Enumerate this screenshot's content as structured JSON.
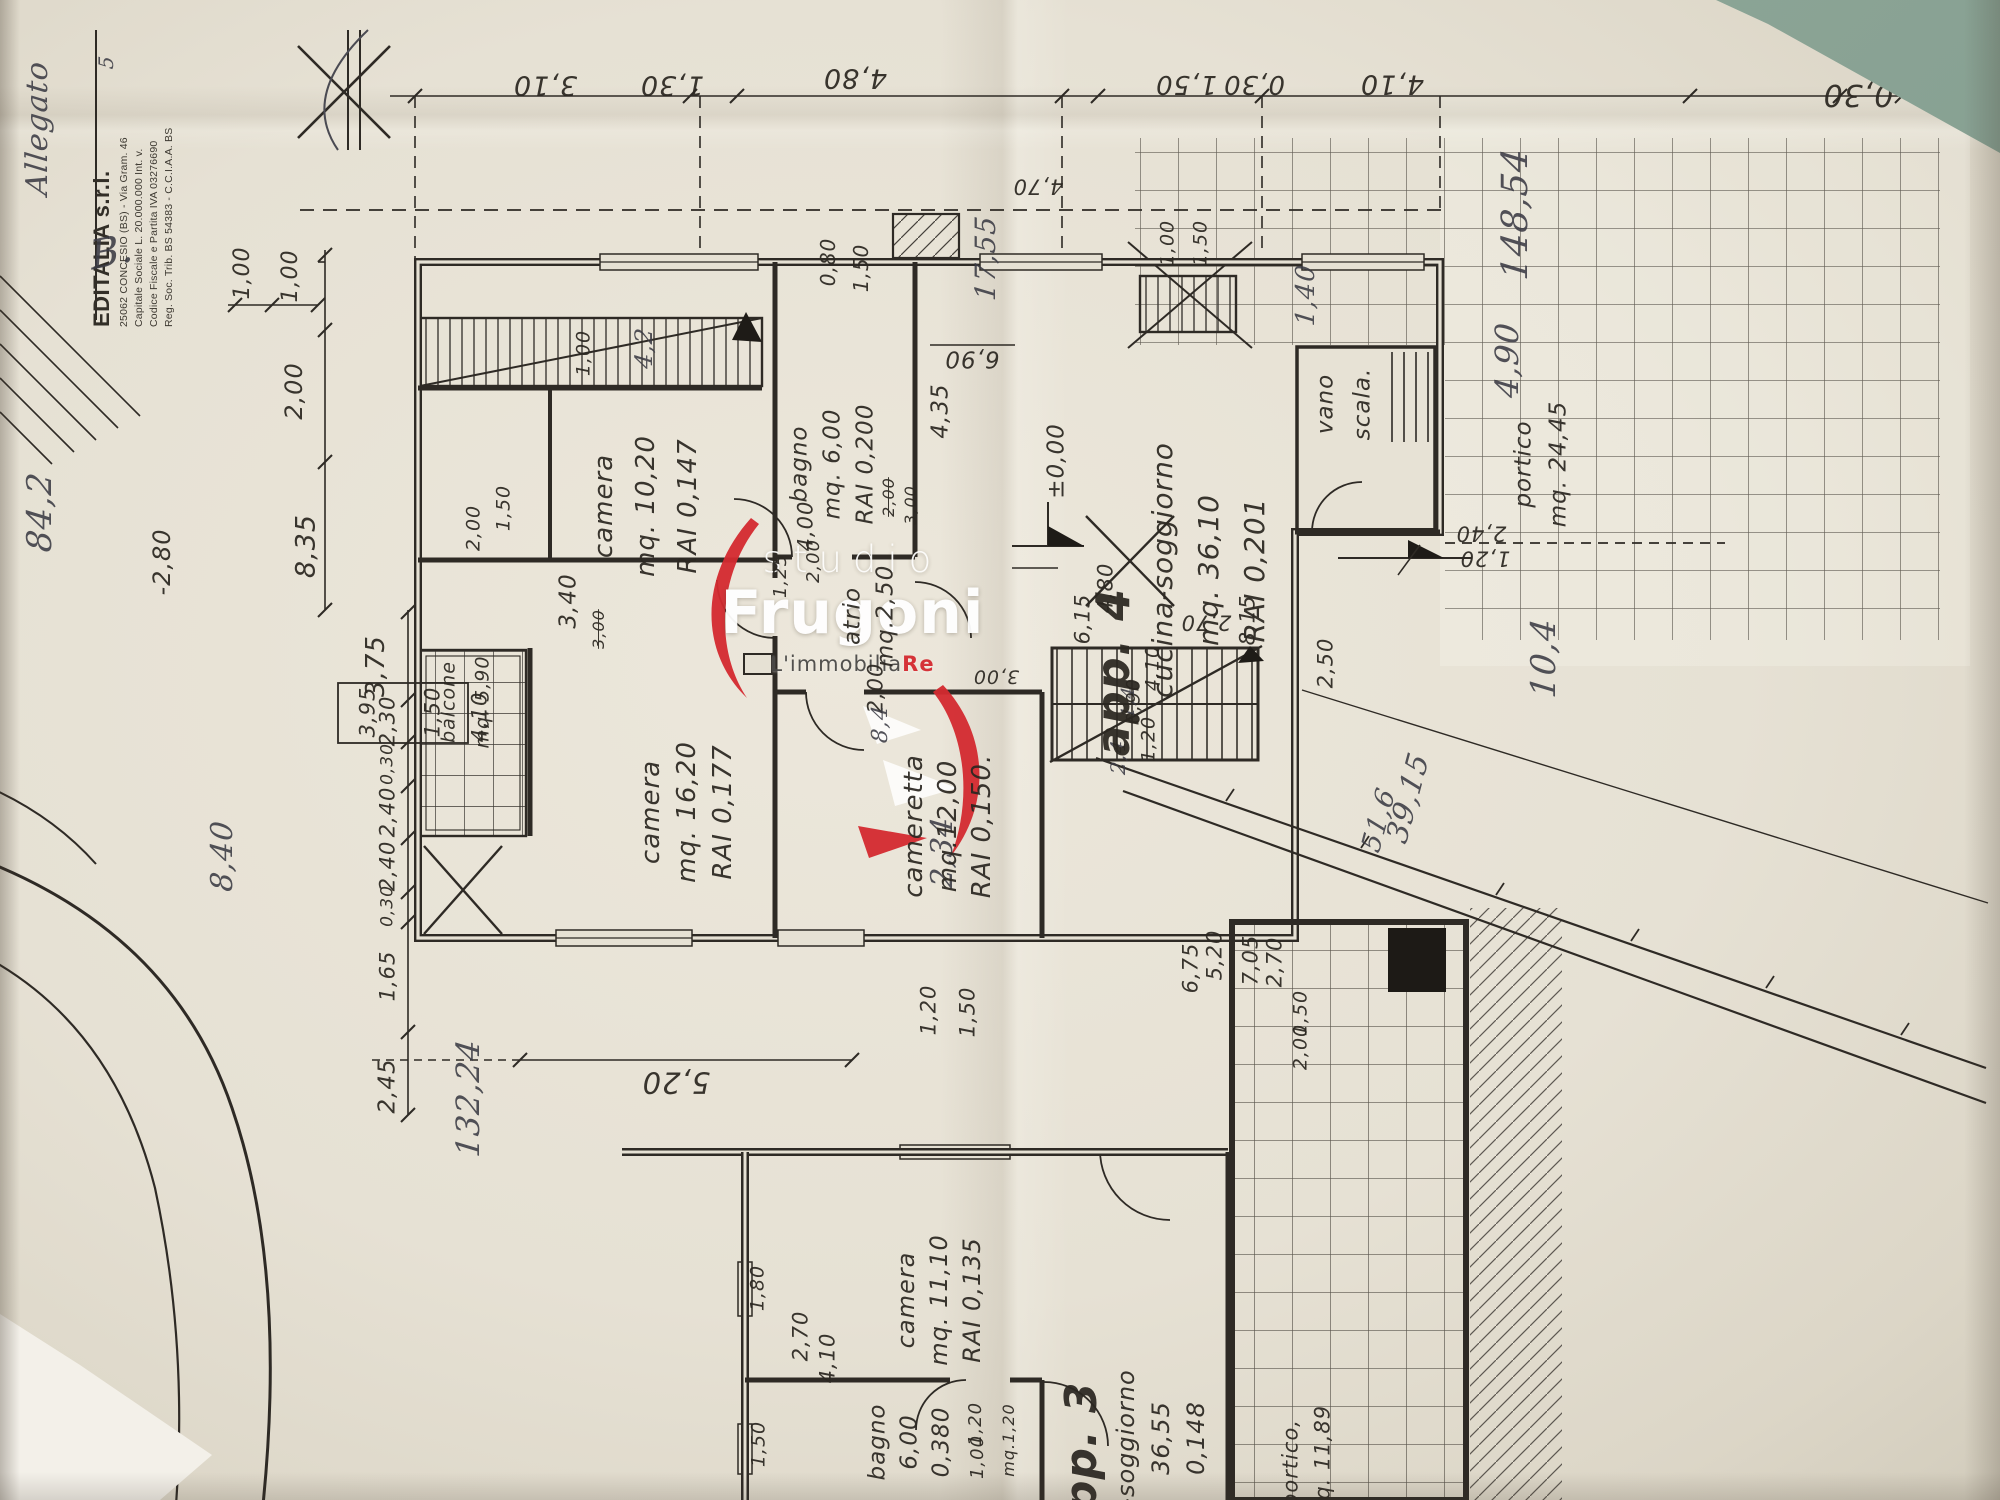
{
  "scene": {
    "type": "scanned floor plan photograph, drawing rotated 90 degrees",
    "paper_color": "#e6e1d4",
    "line_color": "#2e2a25",
    "background_color": "#8aa394",
    "accent_red": "#d42a30"
  },
  "stamp": {
    "company": "EDITALIA s.r.l.",
    "lines": [
      "25062 CONCESIO (BS) - Via Gram. 46",
      "Capitale Sociale L. 20.000.000 Int. v.",
      "Codice Fiscale e Partita IVA 03276690",
      "Reg. Soc. Trib. BS 54383 - C.C.I.A.A. BS"
    ]
  },
  "logo": {
    "studio": "studio",
    "name": "Frugoni",
    "tagline": "L'immobilia",
    "tagline_accent": "Re",
    "accent_color": "#d42a30"
  },
  "rooms": [
    {
      "id": "camera-10",
      "lines": [
        "camera",
        "mq. 10,20",
        "RAI 0,147"
      ],
      "x": 604,
      "y": 506,
      "dx": 42,
      "s": 26
    },
    {
      "id": "bagno",
      "lines": [
        "bagno",
        "mq. 6,00",
        "RAI 0,200"
      ],
      "x": 800,
      "y": 464,
      "dx": 33,
      "s": 23
    },
    {
      "id": "atrio",
      "lines": [
        "atrio",
        "mq.2,50"
      ],
      "x": 853,
      "y": 616,
      "dx": 33,
      "s": 23
    },
    {
      "id": "camera-16",
      "lines": [
        "camera",
        "mq. 16,20",
        "RAI 0,177"
      ],
      "x": 651,
      "y": 812,
      "dx": 36,
      "s": 26
    },
    {
      "id": "cameretta",
      "lines": [
        "cameretta",
        "mq.12,00",
        "RAI 0,150."
      ],
      "x": 914,
      "y": 826,
      "dx": 34,
      "s": 26
    },
    {
      "id": "balcone",
      "lines": [
        "balcone",
        "mq. 5,90"
      ],
      "x": 449,
      "y": 702,
      "dx": 34,
      "s": 19
    },
    {
      "id": "app4",
      "lines": [
        "app. 4"
      ],
      "x": 1113,
      "y": 672,
      "dx": 0,
      "s": 46,
      "w": "bold"
    },
    {
      "id": "cucina-soggiorno",
      "lines": [
        "cucina-soggiorno",
        "mq. 36,10",
        "RAI 0,201"
      ],
      "x": 1163,
      "y": 570,
      "dx": 46,
      "s": 28
    },
    {
      "id": "vano-scala",
      "lines": [
        "vano",
        "scala."
      ],
      "x": 1326,
      "y": 404,
      "dx": 37,
      "s": 23
    },
    {
      "id": "portico-upper",
      "lines": [
        "portico",
        "mq. 24,45"
      ],
      "x": 1524,
      "y": 464,
      "dx": 35,
      "s": 23
    },
    {
      "id": "camera-11",
      "lines": [
        "camera",
        "mq. 11,10",
        "RAI 0,135"
      ],
      "x": 906,
      "y": 1300,
      "dx": 33,
      "s": 24
    },
    {
      "id": "bagno-app3",
      "lines": [
        "bagno",
        "6,00",
        "0,380"
      ],
      "x": 878,
      "y": 1442,
      "dx": 32,
      "s": 23
    },
    {
      "id": "app3",
      "lines": [
        "app. 3"
      ],
      "x": 1082,
      "y": 1462,
      "dx": 0,
      "s": 44,
      "w": "bold"
    },
    {
      "id": "soggiorno-app3",
      "lines": [
        "-soggiorno",
        "36,55",
        "0,148"
      ],
      "x": 1126,
      "y": 1438,
      "dx": 35,
      "s": 24
    },
    {
      "id": "portico-lower",
      "lines": [
        "portico,",
        "mq. 11,89"
      ],
      "x": 1291,
      "y": 1463,
      "dx": 32,
      "s": 21
    }
  ],
  "dim_labels": [
    {
      "t": "3,10",
      "x": 545,
      "y": 85,
      "r": 180,
      "s": 27
    },
    {
      "t": "1,30",
      "x": 672,
      "y": 85,
      "r": 180,
      "s": 27
    },
    {
      "t": "4,80",
      "x": 855,
      "y": 78,
      "r": 180,
      "s": 27
    },
    {
      "t": "1,50",
      "x": 1186,
      "y": 84,
      "r": 180,
      "s": 26
    },
    {
      "t": "0,30",
      "x": 1254,
      "y": 84,
      "r": 180,
      "s": 26
    },
    {
      "t": "4,10",
      "x": 1392,
      "y": 84,
      "r": 180,
      "s": 27
    },
    {
      "t": "0,30",
      "x": 1858,
      "y": 94,
      "r": 180,
      "s": 30
    },
    {
      "t": "4,70",
      "x": 1038,
      "y": 186,
      "r": 180,
      "s": 21
    },
    {
      "t": "1,00",
      "x": 243,
      "y": 273,
      "r": -90,
      "s": 22
    },
    {
      "t": "1,00",
      "x": 291,
      "y": 276,
      "r": -90,
      "s": 22
    },
    {
      "t": "2,00",
      "x": 294,
      "y": 391,
      "r": -90,
      "s": 24
    },
    {
      "t": "8,35",
      "x": 306,
      "y": 546,
      "r": -90,
      "s": 27
    },
    {
      "t": "-2,80",
      "x": 162,
      "y": 562,
      "r": -90,
      "s": 24
    },
    {
      "t": "3,75",
      "x": 376,
      "y": 666,
      "r": -90,
      "s": 26
    },
    {
      "t": "2,30",
      "x": 388,
      "y": 721,
      "r": -90,
      "s": 21
    },
    {
      "t": "0,30",
      "x": 388,
      "y": 764,
      "r": -90,
      "s": 17
    },
    {
      "t": "2,40",
      "x": 388,
      "y": 812,
      "r": -90,
      "s": 21
    },
    {
      "t": "2,40",
      "x": 388,
      "y": 866,
      "r": -90,
      "s": 21
    },
    {
      "t": "0,30",
      "x": 388,
      "y": 906,
      "r": -90,
      "s": 17
    },
    {
      "t": "1,65",
      "x": 388,
      "y": 976,
      "r": -90,
      "s": 21
    },
    {
      "t": "2,45",
      "x": 388,
      "y": 1086,
      "r": -90,
      "s": 23
    },
    {
      "t": "3,95",
      "x": 368,
      "y": 712,
      "r": -90,
      "s": 21
    },
    {
      "t": "1,50",
      "x": 433,
      "y": 712,
      "r": -90,
      "s": 21
    },
    {
      "t": "4,10",
      "x": 480,
      "y": 717,
      "r": -90,
      "s": 21
    },
    {
      "t": "1,00",
      "x": 584,
      "y": 353,
      "r": -90,
      "s": 19
    },
    {
      "t": "2,00",
      "x": 474,
      "y": 528,
      "r": -90,
      "s": 19
    },
    {
      "t": "1,50",
      "x": 504,
      "y": 508,
      "r": -90,
      "s": 19
    },
    {
      "t": "3,40",
      "x": 569,
      "y": 601,
      "r": -90,
      "s": 23
    },
    {
      "t": "3,00",
      "x": 599,
      "y": 629,
      "r": -90,
      "s": 16,
      "strike": true
    },
    {
      "t": "0,80",
      "x": 828,
      "y": 262,
      "r": -90,
      "s": 20
    },
    {
      "t": "1,50",
      "x": 861,
      "y": 268,
      "r": -90,
      "s": 20
    },
    {
      "t": "2,00",
      "x": 889,
      "y": 497,
      "r": -90,
      "s": 16,
      "strike": true
    },
    {
      "t": "3,00",
      "x": 911,
      "y": 505,
      "r": -90,
      "s": 16
    },
    {
      "t": "1,25",
      "x": 781,
      "y": 576,
      "r": -90,
      "s": 18
    },
    {
      "t": "2,00",
      "x": 814,
      "y": 561,
      "r": -90,
      "s": 18
    },
    {
      "t": "6,90",
      "x": 972,
      "y": 358,
      "r": 180,
      "s": 23
    },
    {
      "t": "4,35",
      "x": 941,
      "y": 411,
      "r": -90,
      "s": 23
    },
    {
      "t": "±0,00",
      "x": 1057,
      "y": 461,
      "r": -90,
      "s": 23
    },
    {
      "t": "4,00",
      "x": 806,
      "y": 526,
      "r": -90,
      "s": 21
    },
    {
      "t": "3,00",
      "x": 996,
      "y": 676,
      "r": 180,
      "s": 19
    },
    {
      "t": "1,00",
      "x": 1168,
      "y": 243,
      "r": -90,
      "s": 19
    },
    {
      "t": "1,50",
      "x": 1201,
      "y": 243,
      "r": -90,
      "s": 19
    },
    {
      "t": "2,40",
      "x": 1481,
      "y": 533,
      "r": 180,
      "s": 21
    },
    {
      "t": "1,20",
      "x": 1485,
      "y": 558,
      "r": 180,
      "s": 21
    },
    {
      "t": "2,50",
      "x": 1326,
      "y": 663,
      "r": -90,
      "s": 21
    },
    {
      "t": "2,70",
      "x": 1206,
      "y": 622,
      "r": 180,
      "s": 21
    },
    {
      "t": "8,15",
      "x": 1248,
      "y": 620,
      "r": -90,
      "s": 21
    },
    {
      "t": "6,15",
      "x": 1083,
      "y": 619,
      "r": -90,
      "s": 21
    },
    {
      "t": "4,80",
      "x": 1106,
      "y": 588,
      "r": -90,
      "s": 21
    },
    {
      "t": "2,00",
      "x": 876,
      "y": 688,
      "r": -90,
      "s": 21
    },
    {
      "t": "4,10",
      "x": 1153,
      "y": 668,
      "r": -90,
      "s": 19
    },
    {
      "t": "0,90",
      "x": 1134,
      "y": 701,
      "r": -90,
      "s": 19
    },
    {
      "t": "1,20",
      "x": 1149,
      "y": 739,
      "r": -90,
      "s": 19
    },
    {
      "t": "1,20",
      "x": 929,
      "y": 1010,
      "r": -90,
      "s": 21
    },
    {
      "t": "1,50",
      "x": 968,
      "y": 1012,
      "r": -90,
      "s": 21
    },
    {
      "t": "5,20",
      "x": 676,
      "y": 1082,
      "r": 180,
      "s": 29
    },
    {
      "t": "1,80",
      "x": 758,
      "y": 1288,
      "r": -90,
      "s": 19
    },
    {
      "t": "1,50",
      "x": 759,
      "y": 1444,
      "r": -90,
      "s": 19
    },
    {
      "t": "2,70",
      "x": 801,
      "y": 1336,
      "r": -90,
      "s": 21
    },
    {
      "t": "4,10",
      "x": 828,
      "y": 1358,
      "r": -90,
      "s": 21
    },
    {
      "t": "1,20",
      "x": 976,
      "y": 1424,
      "r": -90,
      "s": 18
    },
    {
      "t": "1,00",
      "x": 978,
      "y": 1457,
      "r": -90,
      "s": 18
    },
    {
      "t": "mq.1,20",
      "x": 1009,
      "y": 1440,
      "r": -90,
      "s": 16
    },
    {
      "t": "6,75",
      "x": 1191,
      "y": 968,
      "r": -90,
      "s": 21
    },
    {
      "t": "5,20",
      "x": 1215,
      "y": 955,
      "r": -90,
      "s": 21
    },
    {
      "t": "7,05",
      "x": 1251,
      "y": 960,
      "r": -90,
      "s": 21
    },
    {
      "t": "2,70",
      "x": 1275,
      "y": 962,
      "r": -90,
      "s": 21
    },
    {
      "t": "1,50",
      "x": 1301,
      "y": 1013,
      "r": -90,
      "s": 19
    },
    {
      "t": "2,00",
      "x": 1301,
      "y": 1047,
      "r": -90,
      "s": 19
    }
  ],
  "handwritten": [
    {
      "t": "Allegato",
      "x": 38,
      "y": 128,
      "r": -90,
      "s": 30
    },
    {
      "t": "B.",
      "x": 112,
      "y": 252,
      "r": -12,
      "s": 40
    },
    {
      "t": "5",
      "x": 106,
      "y": 62,
      "r": -90,
      "s": 20
    },
    {
      "t": "84,2",
      "x": 40,
      "y": 512,
      "r": -90,
      "s": 34
    },
    {
      "t": "8,40",
      "x": 223,
      "y": 856,
      "r": -90,
      "s": 30
    },
    {
      "t": "132,24",
      "x": 468,
      "y": 1098,
      "r": -90,
      "s": 32
    },
    {
      "t": "17,55",
      "x": 986,
      "y": 258,
      "r": -90,
      "s": 28
    },
    {
      "t": "4,2",
      "x": 644,
      "y": 348,
      "r": -90,
      "s": 24
    },
    {
      "t": "8,4",
      "x": 881,
      "y": 724,
      "r": -90,
      "s": 22
    },
    {
      "t": "2,34",
      "x": 943,
      "y": 852,
      "r": -90,
      "s": 30
    },
    {
      "t": "1,40",
      "x": 1306,
      "y": 295,
      "r": -90,
      "s": 26
    },
    {
      "t": "2,4",
      "x": 1118,
      "y": 757,
      "r": -90,
      "s": 20
    },
    {
      "t": "1,4",
      "x": 1129,
      "y": 702,
      "r": -90,
      "s": 18
    },
    {
      "t": "148,54",
      "x": 1516,
      "y": 214,
      "r": -90,
      "s": 36
    },
    {
      "t": "4,90",
      "x": 1507,
      "y": 360,
      "r": -90,
      "s": 32
    },
    {
      "t": "10,4",
      "x": 1544,
      "y": 658,
      "r": -90,
      "s": 34
    },
    {
      "t": "39,15",
      "x": 1409,
      "y": 798,
      "r": -75,
      "s": 30
    },
    {
      "t": "51,6",
      "x": 1379,
      "y": 820,
      "r": -75,
      "s": 27
    }
  ]
}
